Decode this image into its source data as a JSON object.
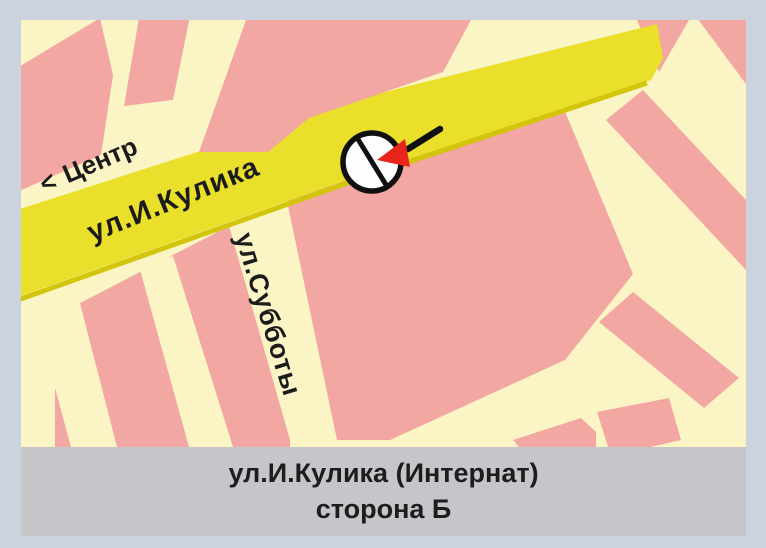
{
  "frame": {
    "background": "#ccd3df"
  },
  "map": {
    "background": "#fbf5c6",
    "block_color": "#f2a7a2",
    "road": {
      "name": "ул.И.Кулика",
      "color": "#eadf2b",
      "edge_color": "#d2c50a"
    },
    "direction": {
      "arrow": "<",
      "label": "Центр"
    },
    "cross_street": {
      "name": "ул.Субботы"
    },
    "marker": {
      "fill": "#fdfeff",
      "outline": "#101010",
      "arrow_color": "#e8251c"
    }
  },
  "caption": {
    "background": "#c6c5c9",
    "line1": "ул.И.Кулика (Интернат)",
    "line2": "сторона Б"
  }
}
